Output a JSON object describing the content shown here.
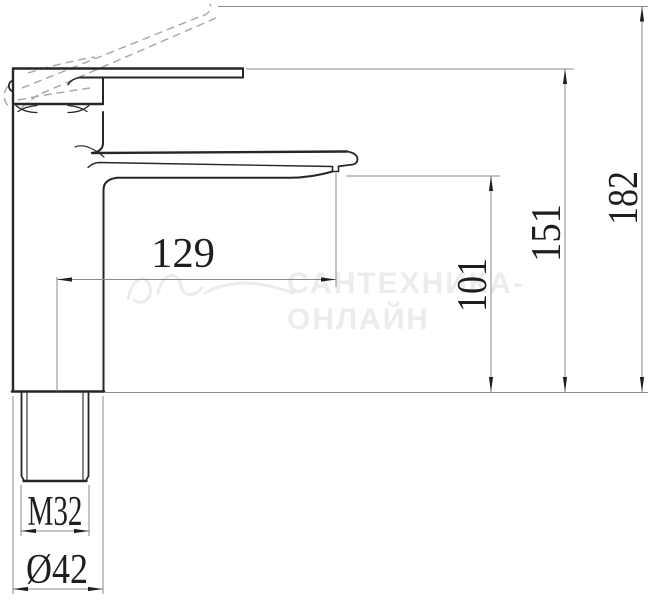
{
  "drawing": {
    "kind": "faucet-technical-drawing",
    "view": "side-elevation",
    "dimension_labels": {
      "spout_reach": "129",
      "outlet_height": "101",
      "body_top_height": "151",
      "overall_height": "182",
      "thread": "M32",
      "base_diameter": "Ø42"
    },
    "watermark": {
      "line1": "САНТЕХНИКА-",
      "line2": "ОНЛАЙН"
    },
    "colors": {
      "outline": "#262626",
      "dimension_lines": "#8a8a8a",
      "hidden_dashed": "#a6a6a6",
      "watermark": "#ececec",
      "background": "#ffffff"
    }
  }
}
